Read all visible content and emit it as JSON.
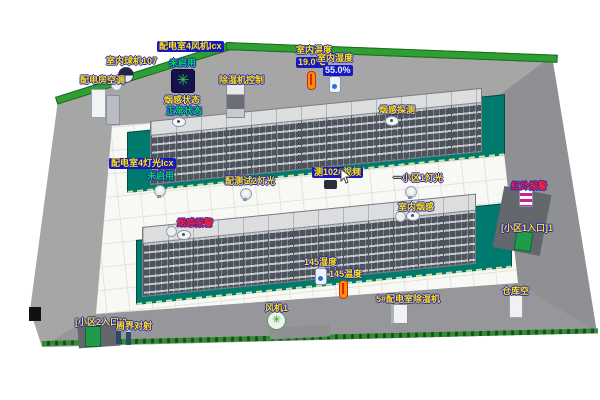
{
  "colors": {
    "label_bg": "#1717c4",
    "label_yellow": "#ffe400",
    "status_green": "#00dc3c",
    "alarm_red": "#ff2222",
    "platform_teal": "#00796e"
  },
  "icons": {
    "fan_glyph": "✳"
  },
  "back_wall": {
    "fan_unit_label": "配电室4风机Icx",
    "fan_unit_status": "未启用",
    "dome_camera_label": "室内球机107",
    "ac_label": "配电房空调",
    "dehumidifier_ctrl_label": "除湿机控制",
    "smoke_status_label": "烟感状态",
    "smoke_status_value": "正常状态",
    "indoor_temp_label": "室内温度",
    "indoor_temp_value": "19.0℃",
    "indoor_humidity_label": "室内湿度",
    "indoor_humidity_value": "55.0%"
  },
  "rack_row_1": {
    "smoke_detect_label": "烟感探测",
    "lights_label": "配电室4灯光Icx",
    "lights_status": "未启用",
    "test_light_label": "配测试2灯光",
    "video_label": "测102#视频",
    "zone_light_label": "一小区1灯光",
    "indoor_smoke_label": "室内烟感"
  },
  "rack_row_2": {
    "smoke_alarm_label": "烟感报警",
    "humidity_label": "145湿度",
    "temp_label": "145温度",
    "dehumidifier_label": "5#配电室除湿机"
  },
  "right_wall": {
    "infrared_alarm_label": "红外报警",
    "entrance_label": "[小区1入口]1"
  },
  "bottom_area": {
    "fan_label": "风机1",
    "warehouse_label": "仓库空",
    "entrance_label": "[小区2入口]2",
    "perimeter_label": "周界对射"
  }
}
